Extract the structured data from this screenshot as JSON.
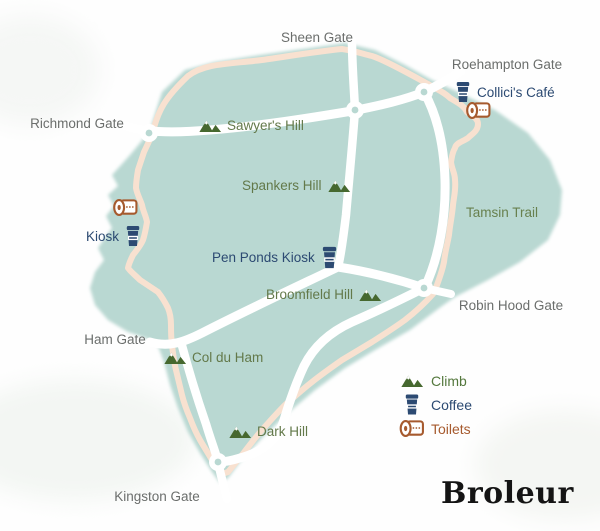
{
  "map": {
    "title": "Richmond Park route map",
    "colors": {
      "park_fill": "#b9d8d2",
      "trail": "#f8e1d0",
      "road": "#ffffff",
      "gate_label": "#6b6e6c",
      "hill_label": "#63794a",
      "climb_icon_green": "#46682f",
      "coffee_navy": "#2c4a72",
      "toilet_rust": "#a65a2e",
      "brand_black": "#141414"
    },
    "gates": [
      {
        "name": "sheen-gate",
        "label": "Sheen Gate"
      },
      {
        "name": "roehampton-gate",
        "label": "Roehampton Gate"
      },
      {
        "name": "richmond-gate",
        "label": "Richmond Gate"
      },
      {
        "name": "robin-hood-gate",
        "label": "Robin Hood Gate"
      },
      {
        "name": "ham-gate",
        "label": "Ham Gate"
      },
      {
        "name": "kingston-gate",
        "label": "Kingston Gate"
      }
    ],
    "climbs": [
      {
        "name": "sawyers-hill",
        "label": "Sawyer's Hill"
      },
      {
        "name": "spankers-hill",
        "label": "Spankers Hill"
      },
      {
        "name": "broomfield-hill",
        "label": "Broomfield Hill"
      },
      {
        "name": "col-du-ham",
        "label": "Col du Ham"
      },
      {
        "name": "dark-hill",
        "label": "Dark Hill"
      }
    ],
    "trail_label": {
      "label": "Tamsin Trail"
    },
    "pois": [
      {
        "name": "collicis-cafe",
        "label": "Collici's Café",
        "icons": [
          "coffee-icon",
          "toilets-icon"
        ]
      },
      {
        "name": "kiosk",
        "label": "Kiosk",
        "icons": [
          "coffee-icon",
          "toilets-icon"
        ]
      },
      {
        "name": "pen-ponds-kiosk",
        "label": "Pen Ponds Kiosk",
        "icons": [
          "coffee-icon"
        ]
      }
    ],
    "legend": {
      "items": [
        {
          "icon": "climb-icon",
          "label": "Climb"
        },
        {
          "icon": "coffee-icon",
          "label": "Coffee"
        },
        {
          "icon": "toilets-icon",
          "label": "Toilets"
        }
      ]
    },
    "brand": {
      "label": "Broleur"
    }
  }
}
